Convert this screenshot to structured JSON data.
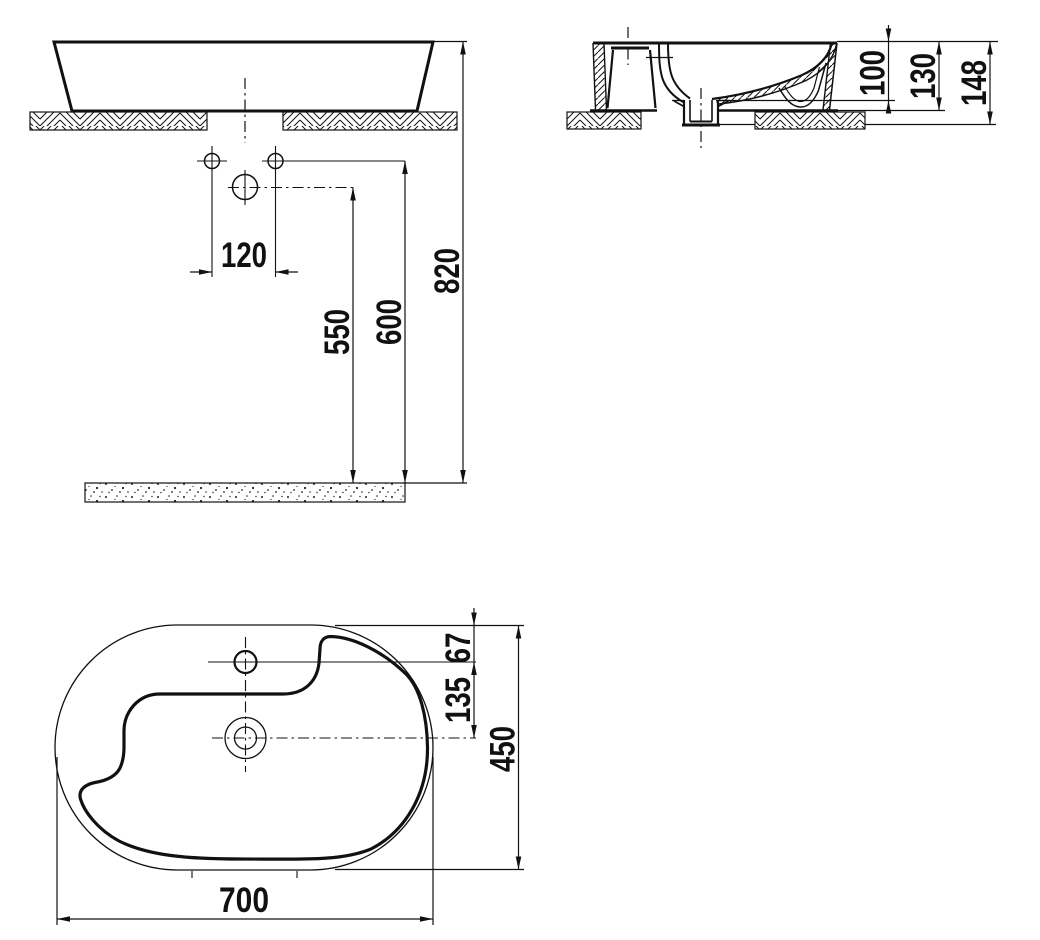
{
  "dims": {
    "d120": "120",
    "d550": "550",
    "d600": "600",
    "d820": "820",
    "d100": "100",
    "d130": "130",
    "d148": "148",
    "d67": "67",
    "d135": "135",
    "d450": "450",
    "d700": "700"
  },
  "colors": {
    "line": "#111111",
    "background": "#ffffff"
  }
}
